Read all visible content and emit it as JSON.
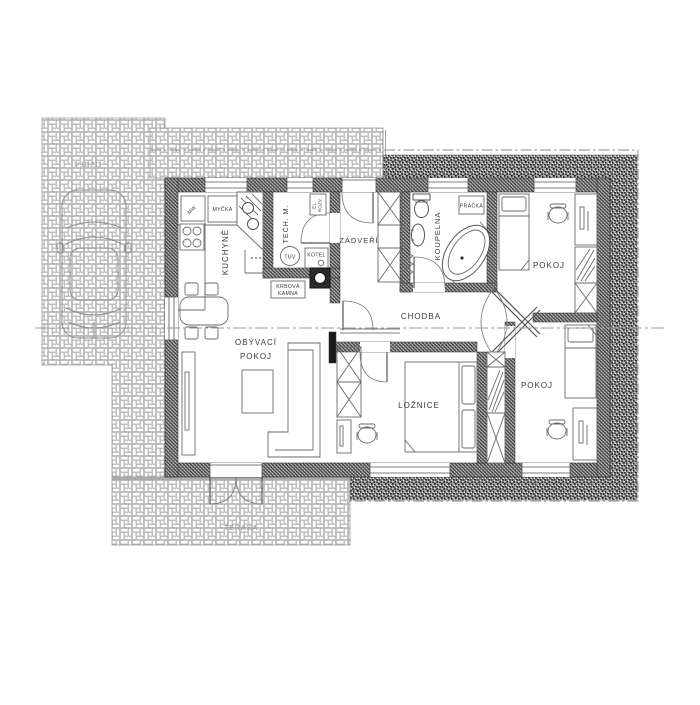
{
  "plan": {
    "title": "house-floor-plan",
    "rooms": {
      "kuchyne": "KUCHYNĚ",
      "obyvaci_line1": "OBÝVACÍ",
      "obyvaci_line2": "POKOJ",
      "tech_m": "TECH. M.",
      "zadveri": "ZÁDVEŘÍ",
      "koupelna": "KOUPELNA",
      "chodba": "CHODBA",
      "pokoj_top": "POKOJ",
      "pokoj_bottom": "POKOJ",
      "loznice": "LOŽNICE",
      "terasa": "TERASA",
      "vjezd": "VJEZD"
    },
    "equipment": {
      "mw": "MW",
      "mycka": "MYČKA",
      "el_rozv_line1": "EL.",
      "el_rozv_line2": "ROZV.",
      "tuv": "TUV",
      "kotel": "KOTEL",
      "krbova_line1": "KRBOVÁ",
      "krbova_line2": "KAMNA",
      "pracka": "PRAČKA"
    },
    "colors": {
      "wall_hatch": "#3a3a3a",
      "gravel": "#8e8e8e",
      "paving_line": "#b3b3b3",
      "line": "#555555",
      "text": "#3a3a3a",
      "background": "#ffffff"
    }
  }
}
